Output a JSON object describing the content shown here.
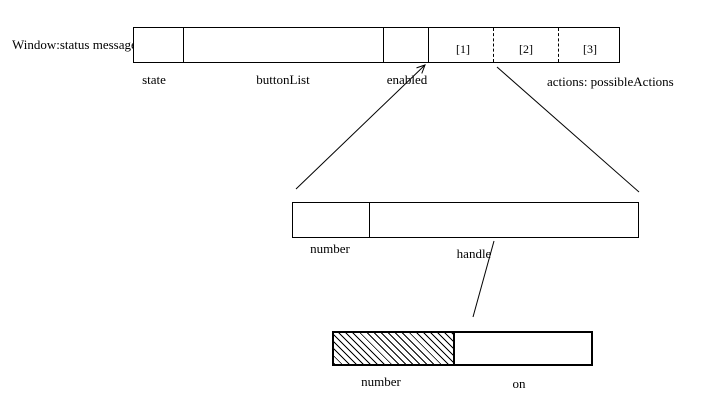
{
  "diagram_title": "Window object internal representation",
  "colors": {
    "ink": "#000000",
    "paper": "#ffffff"
  },
  "window_record": {
    "title": "Window:status message",
    "field_labels": {
      "state": "state",
      "button_list": "buttonList",
      "enabled": "enabled"
    },
    "actions_label": "actions: possibleActions",
    "slots": [
      "[1]",
      "[2]",
      "[3]"
    ]
  },
  "button_record": {
    "field_labels": {
      "number": "number",
      "handle": "handle"
    }
  },
  "handle_record": {
    "field_labels": {
      "number": "number",
      "on": "on"
    }
  }
}
